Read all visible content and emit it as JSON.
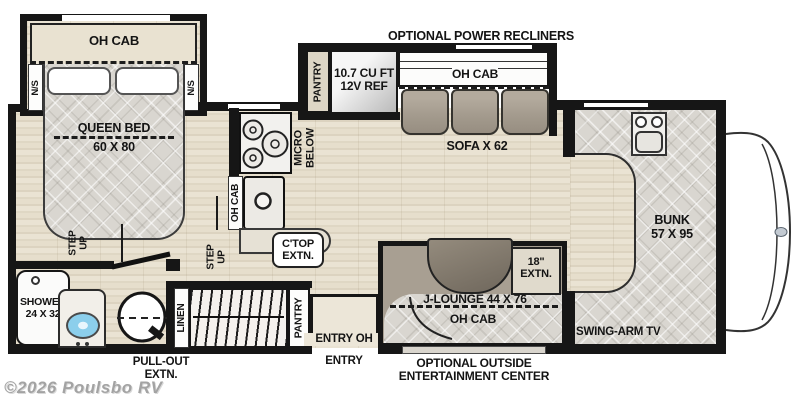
{
  "watermark": "©2026 Poulsbo RV",
  "colors": {
    "wall": "#161616",
    "floor": "#e6dfcf",
    "quilt": "#d9d6d0",
    "cushion": "#a39a8d",
    "table": "#867d70",
    "lav_sink_blue": "#8ccfec"
  },
  "bedroom": {
    "oh_cab": "OH CAB",
    "ns": "N/S",
    "bed_line1": "QUEEN BED",
    "bed_line2": "60 X 80",
    "step_line1": "STEP",
    "step_line2": "UP"
  },
  "bathroom": {
    "shower_line1": "SHOWER",
    "shower_line2": "24 X 32"
  },
  "hall": {
    "linen": "LINEN",
    "step_line1": "STEP",
    "step_line2": "UP",
    "pantry": "PANTRY",
    "pullout_line1": "PULL-OUT",
    "pullout_line2": "EXTN."
  },
  "kitchen": {
    "micro_line1": "MICRO",
    "micro_line2": "BELOW",
    "oh_cab": "OH CAB",
    "ctop_line1": "C'TOP",
    "ctop_line2": "EXTN."
  },
  "slideout": {
    "header": "OPTIONAL POWER RECLINERS",
    "pantry": "PANTRY",
    "fridge_line1": "10.7 CU FT",
    "fridge_line2": "12V REF",
    "oh_cab": "OH CAB",
    "sofa": "SOFA X 62"
  },
  "entry": {
    "inside": "ENTRY OH",
    "outside": "ENTRY"
  },
  "jlounge": {
    "extn_line1": "18\"",
    "extn_line2": "EXTN.",
    "label": "J-LOUNGE 44 X 76",
    "oh_cab": "OH CAB",
    "outside_line1": "OPTIONAL OUTSIDE",
    "outside_line2": "ENTERTAINMENT CENTER"
  },
  "front": {
    "bunk_line1": "BUNK",
    "bunk_line2": "57 X 95",
    "tv": "SWING-ARM TV"
  }
}
